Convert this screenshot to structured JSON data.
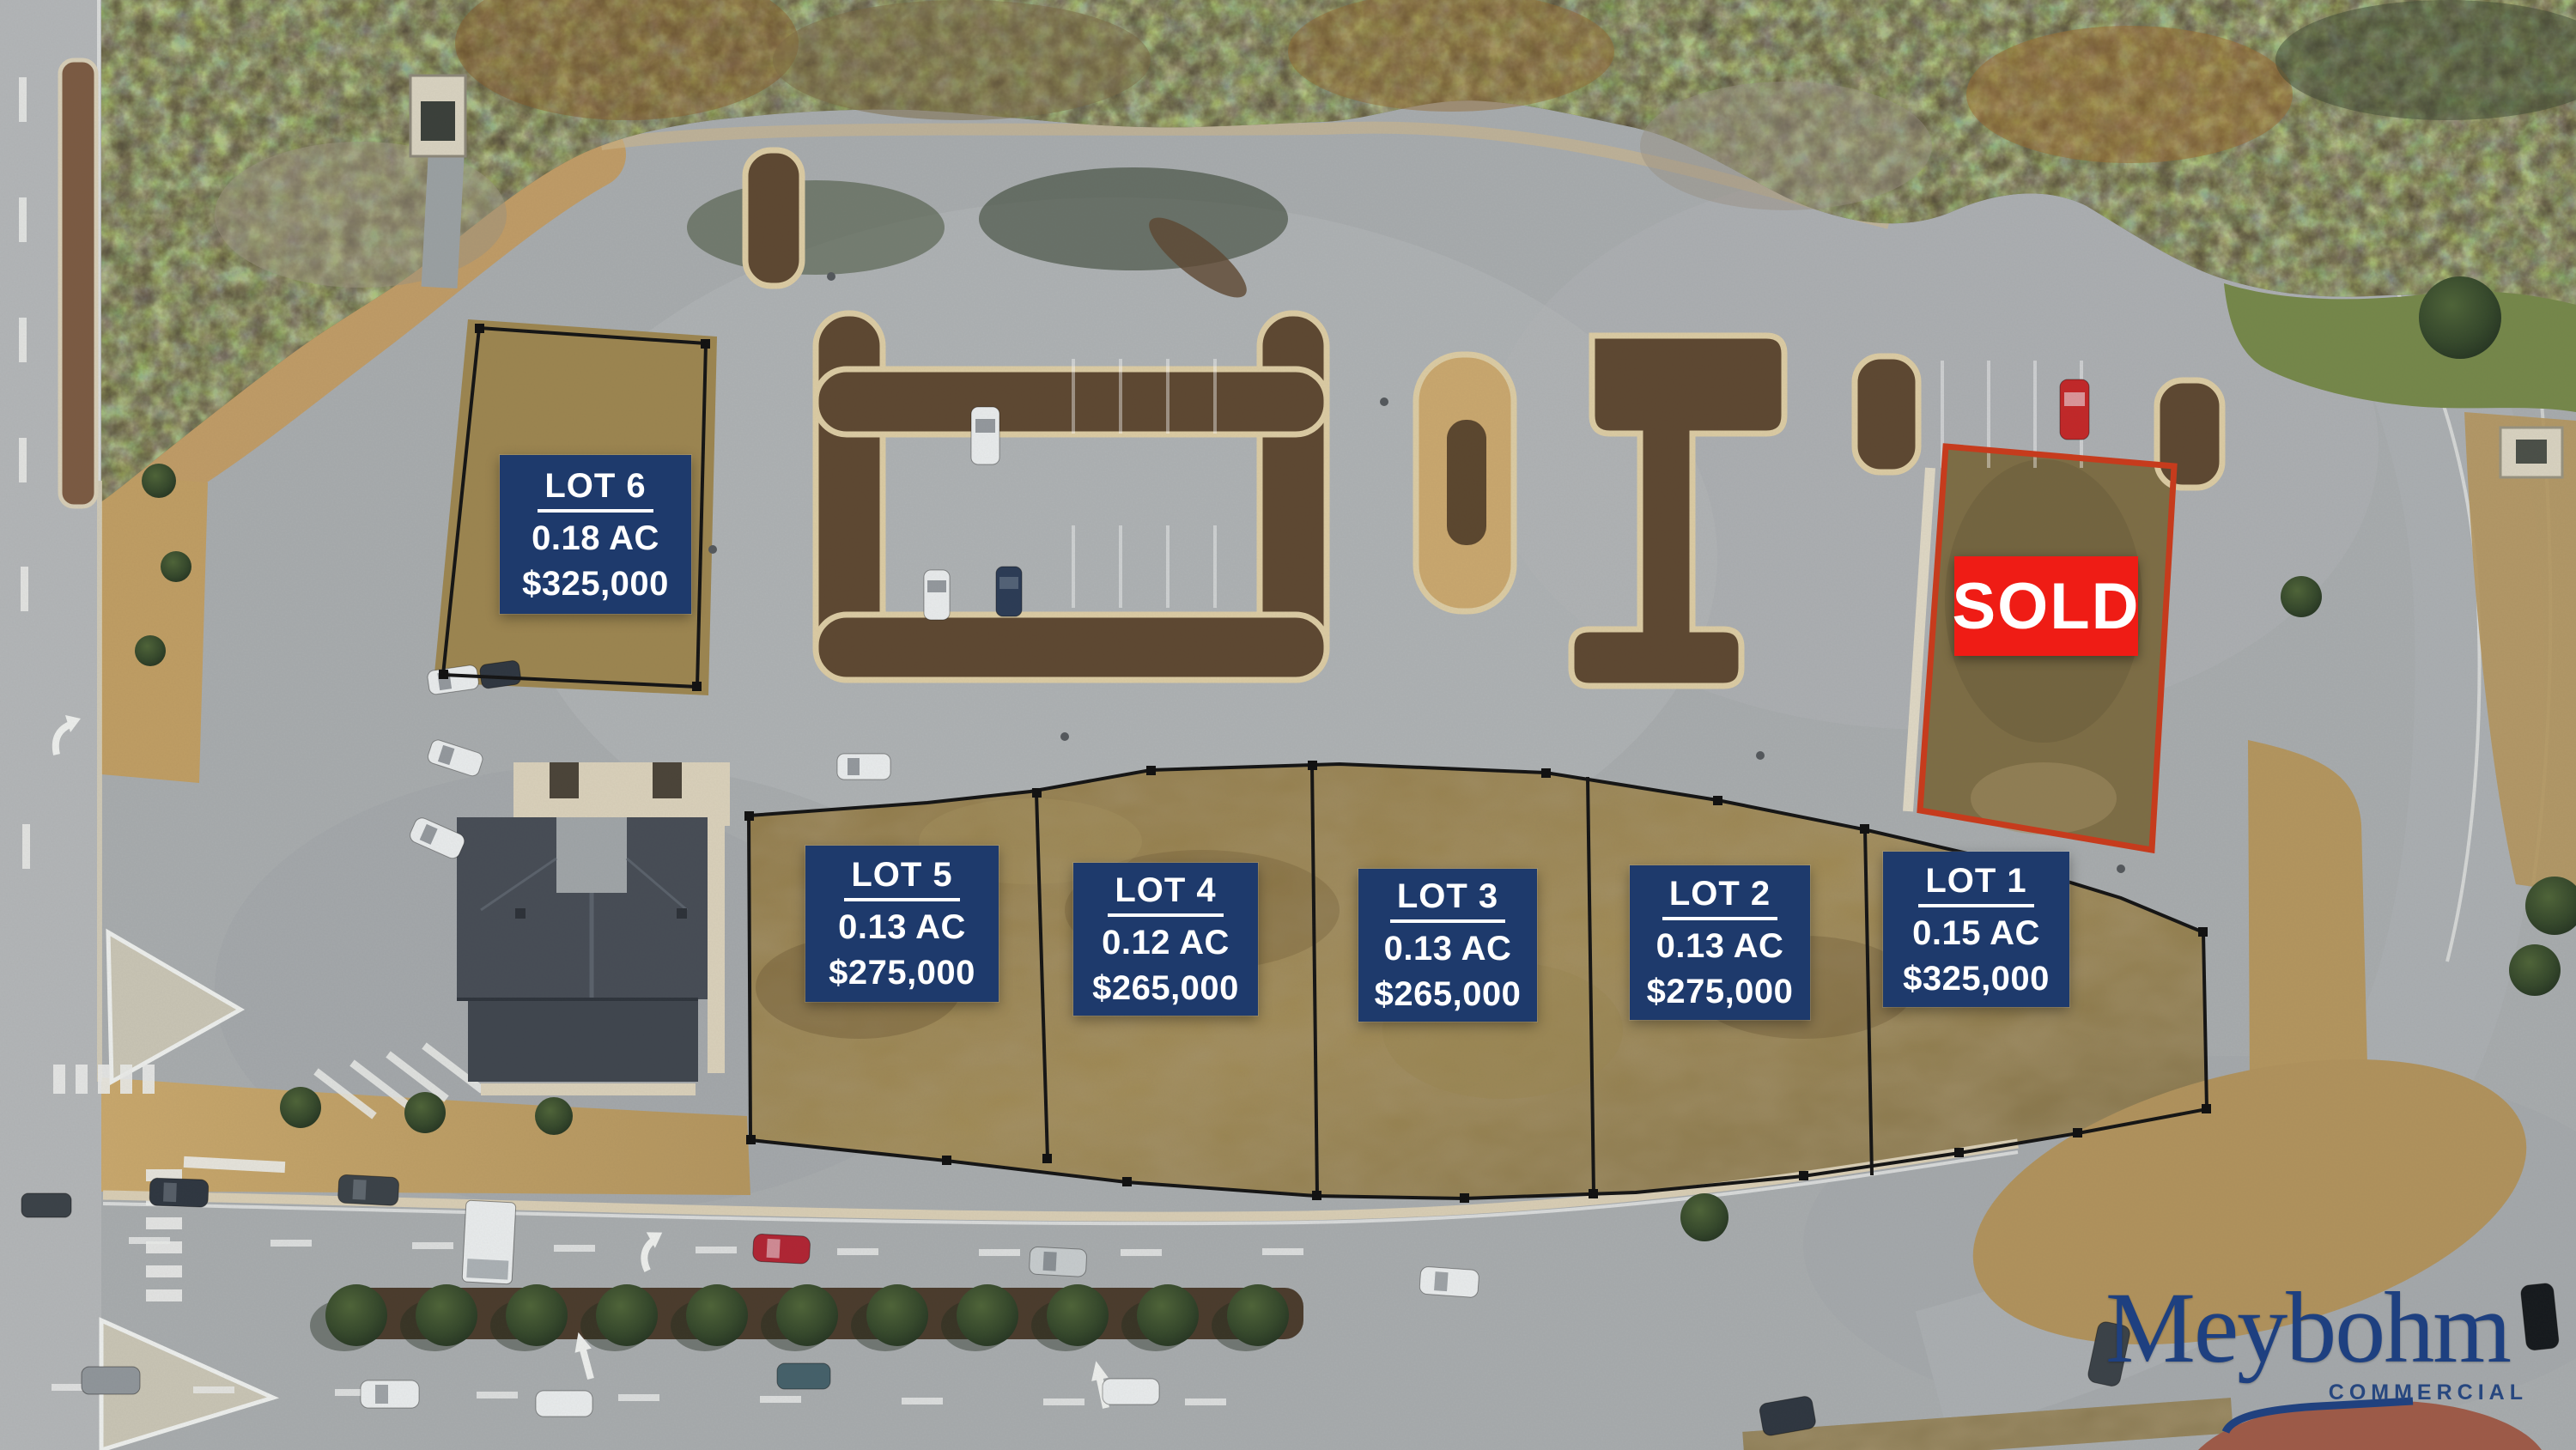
{
  "listing_map": {
    "lots": [
      {
        "name": "LOT 1",
        "area": "0.15 AC",
        "price": "$325,000"
      },
      {
        "name": "LOT 2",
        "area": "0.13 AC",
        "price": "$275,000"
      },
      {
        "name": "LOT 3",
        "area": "0.13 AC",
        "price": "$265,000"
      },
      {
        "name": "LOT 4",
        "area": "0.12 AC",
        "price": "$265,000"
      },
      {
        "name": "LOT 5",
        "area": "0.13 AC",
        "price": "$275,000"
      },
      {
        "name": "LOT 6",
        "area": "0.18 AC",
        "price": "$325,000"
      }
    ],
    "sold_lot": {
      "label": "SOLD"
    },
    "branding": {
      "name": "Meybohm",
      "division": "COMMERCIAL"
    },
    "colors": {
      "label_background": "#1e3a6c",
      "label_text": "#ffffff",
      "sold_background": "#ef1c15",
      "sold_boundary": "#c93a1b",
      "lot_boundary": "#141414",
      "brand_navy": "#1e4080"
    }
  }
}
